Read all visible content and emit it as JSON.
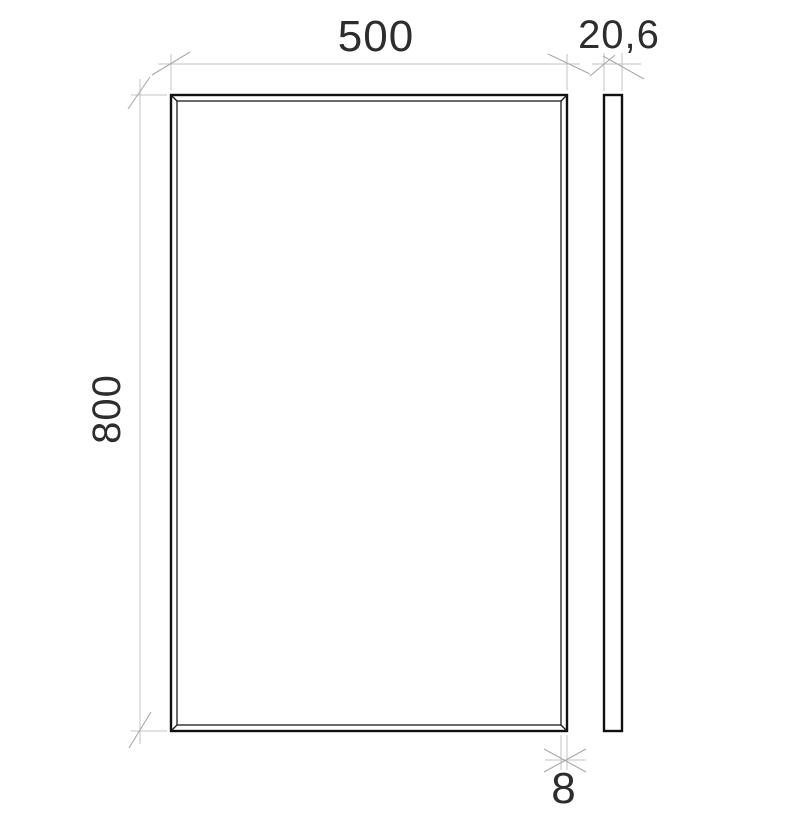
{
  "drawing": {
    "title": "",
    "dimensions": {
      "width": "500",
      "thickness": "20,6",
      "height": "800",
      "bevel": "8"
    },
    "colors": {
      "background": "#ffffff",
      "object_line": "#111111",
      "dimension_line": "#c3c3c3",
      "tick_mark": "#a8a8a8",
      "dimension_text": "#2d2d2d"
    }
  }
}
